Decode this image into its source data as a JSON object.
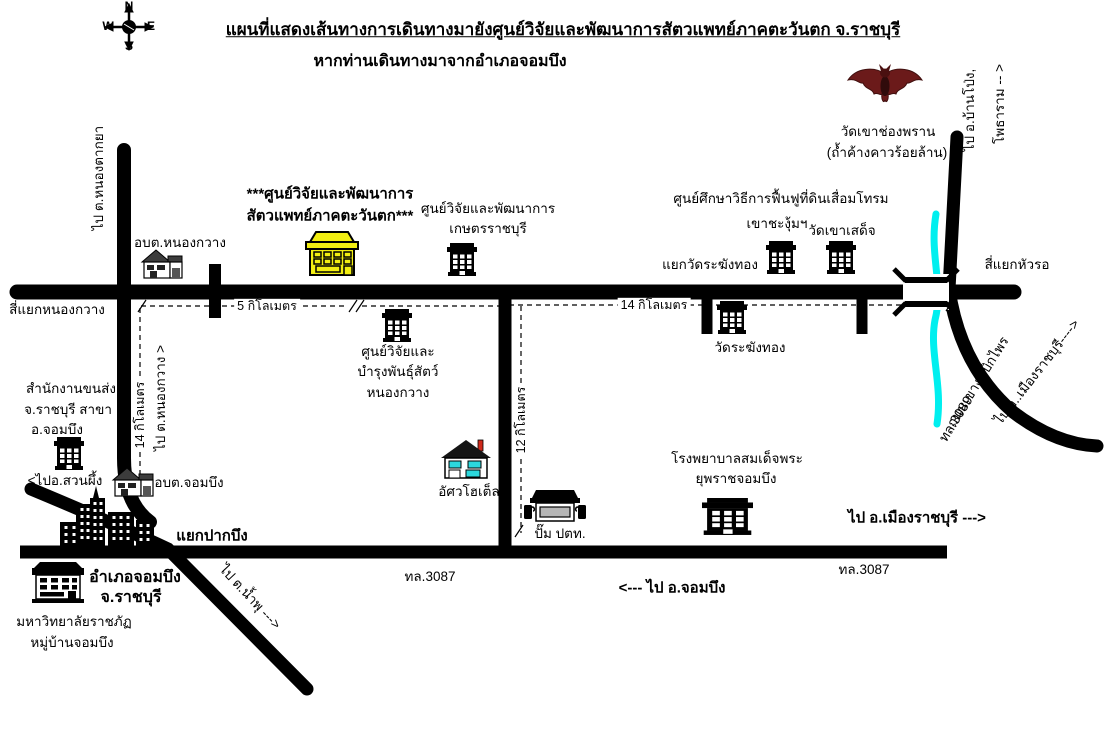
{
  "title": "แผนที่แสดงเส้นทางการเดินทางมายังศูนย์วิจัยและพัฒนาการสัตวแพทย์ภาคตะวันตก จ.ราชบุรี",
  "subtitle": "หากท่านเดินทางมาจากอำเภอจอมบึง",
  "compass": {
    "north": "N",
    "west": "W",
    "east": "E",
    "south": "S"
  },
  "colors": {
    "road": "#000000",
    "river": "#00efef",
    "highlight_building": "#f2ee12",
    "bat_wing": "#6b1a1a",
    "bat_body": "#300b0b",
    "chimney_red": "#cf2a1b",
    "window_cyan": "#2bd8dd",
    "window_gray": "#b5b5b5"
  },
  "icons": {
    "compass-rose": "cross-arrows-with-sphere",
    "bat": "red-bat-silhouette",
    "bridge": "double-bar-bridge-symbol",
    "river": "cyan-wavy-line",
    "office-building": "black-building-white-windows",
    "highlight-building": "yellow-building-black-outline",
    "house": "gable-roof-house",
    "hotel-house": "house-cyan-windows-red-chimney",
    "gas-station": "black-canopy-two-pumps",
    "city-skyline": "black-towers-white-windows"
  },
  "labels": {
    "pai_nongtakya": "ไป ต.หนองตากยา",
    "abt_nongkwang": "อบต.หนองกวาง",
    "siyaek_nongkwang": "สี่แยกหนองกวาง",
    "vet_center_1": "***ศูนย์วิจัยและพัฒนาการ",
    "vet_center_2": "สัตวแพทย์ภาคตะวันตก***",
    "kaset_1": "ศูนย์วิจัยและพัฒนาการ",
    "kaset_2": "เกษตรราชบุรี",
    "livestock_1": "ศูนย์วิจัยและ",
    "livestock_2": "บำรุงพันธุ์สัตว์",
    "livestock_3": "หนองกวาง",
    "land_rehab": "ศูนย์ศึกษาวิธีการฟื้นฟูที่ดินเสื่อมโทรม",
    "khao_changum": "เขาชะงุ้มฯ",
    "wat_khao_sadet": "วัดเขาเสด็จ",
    "yaek_wat_rakang": "แยกวัดระฆังทอง",
    "wat_rakang": "วัดระฆังทอง",
    "wat_chong_phran_1": "วัดเขาช่องพราน",
    "wat_chong_phran_2": "(ถ้ำค้างคาวร้อยล้าน)",
    "pai_banpong": "ไป อ.บ้านโป่ง,",
    "photharam": "โพธาราม -- >",
    "siyaek_huaro": "สี่แยกหัวรอ",
    "khao_ngu_road": "ถนนเขางู-เบิกไพร",
    "tl3089": "ทล.3089",
    "pai_muang_curve": "ไป อ..เมืองราชบุรี---->",
    "transport_1": "สำนักงานขนส่ง",
    "transport_2": "จ.ราชบุรี สาขา",
    "transport_3": "อ.จอมบึง",
    "d14_west": "14 กิโลเมตร",
    "pai_nongkwang": "ไป ต.หนองกวาง >",
    "pai_suanphueng": "<ไปอ.สวนผึ้ง",
    "abt_chombung": "อบต.จอมบึง",
    "yaek_pakbung": "แยกปากบึง",
    "amphoe_1": "อำเภอจอมบึง",
    "amphoe_2": "จ.ราชบุรี",
    "university_1": "มหาวิทยาลัยราชภัฏ",
    "university_2": "หมู่บ้านจอมบึง",
    "pai_namphu": "ไป ต.น้ำพุ --->",
    "asava_hotel": "อัศวโฮเต็ล",
    "ptt_pump": "ปั๊ม ปตท.",
    "d12": "12 กิโลเมตร",
    "d5": "5 กิโลเมตร",
    "d14_main": "14 กิโลเมตร",
    "hospital_1": "โรงพยาบาลสมเด็จพระ",
    "hospital_2": "ยุพราชจอมบึง",
    "pai_muang_bold": "ไป อ.เมืองราชบุรี --->",
    "tl3087_left": "ทล.3087",
    "tl3087_right": "ทล.3087",
    "pai_chombung": "<--- ไป อ.จอมบึง"
  }
}
